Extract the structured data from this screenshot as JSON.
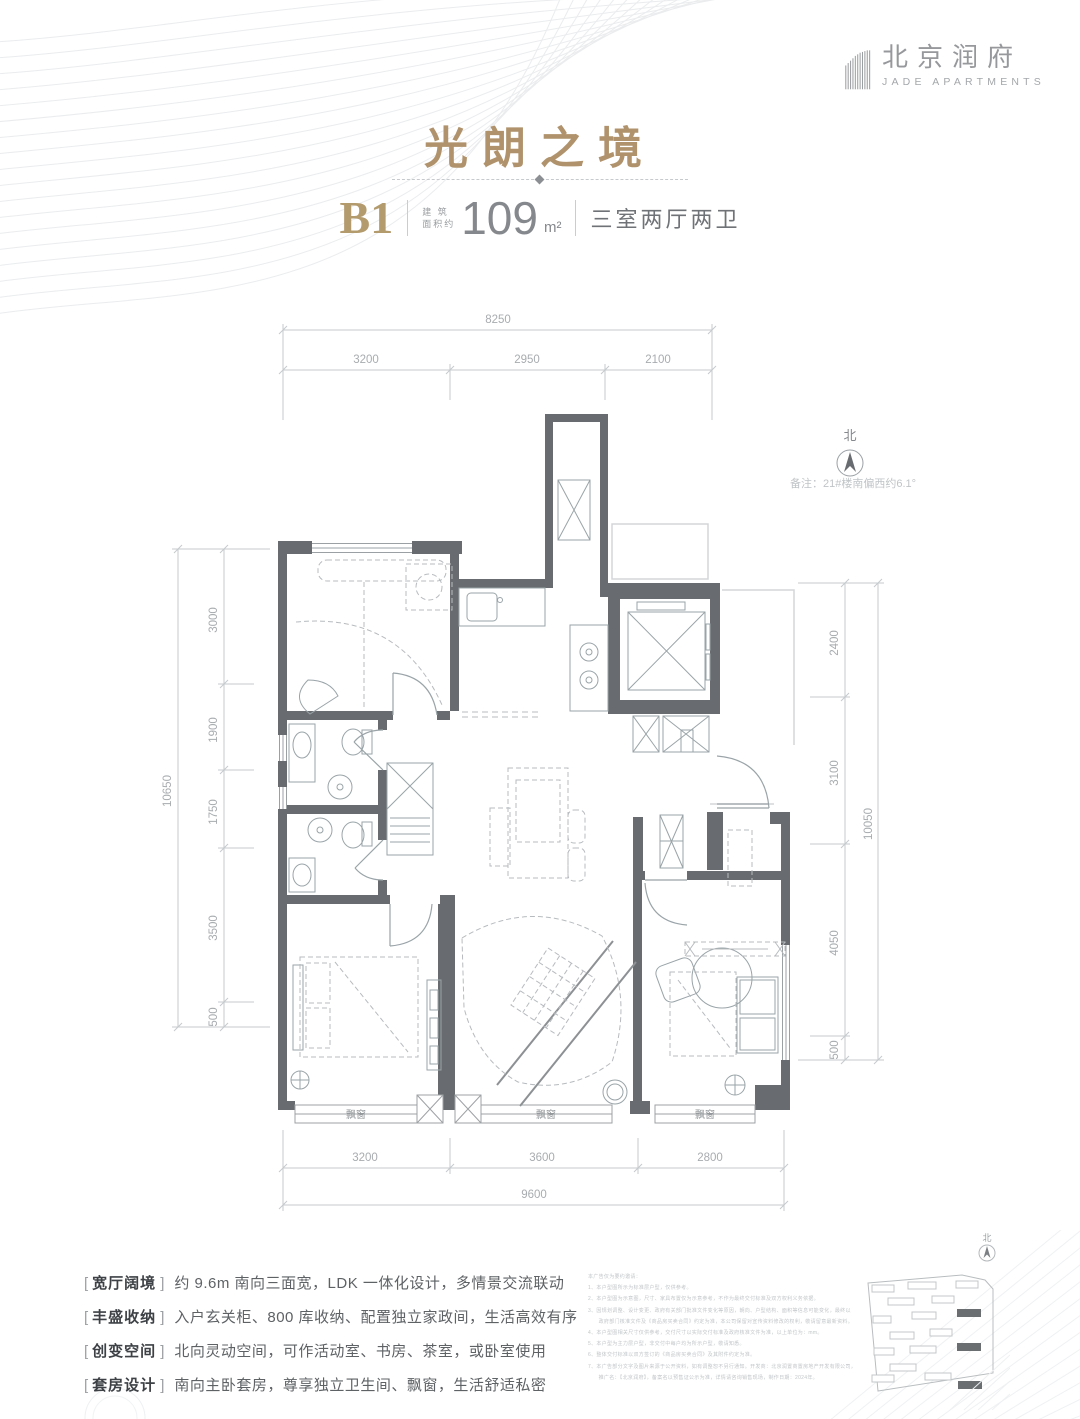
{
  "brand": {
    "name_cn": "北京润府",
    "name_en": "JADE APARTMENTS"
  },
  "title": "光朗之境",
  "unit": {
    "code": "B1",
    "area_label_line1": "建 筑",
    "area_label_line2": "面积约",
    "area_value": "109",
    "area_unit": "m²",
    "layout": "三室两厅两卫"
  },
  "north": {
    "label": "北",
    "note": "备注：21#楼南偏西约6.1°"
  },
  "plan": {
    "dims_top": {
      "total": "8250",
      "segments": [
        "3200",
        "2950",
        "2100"
      ]
    },
    "dims_left": {
      "total": "10650",
      "segments": [
        "3000",
        "1900",
        "1750",
        "3500",
        "500"
      ]
    },
    "dims_right": {
      "total": "10050",
      "segments": [
        "2400",
        "3100",
        "4050",
        "500"
      ]
    },
    "dims_bottom": {
      "total": "9600",
      "segments": [
        "3200",
        "3600",
        "2800"
      ]
    },
    "bay_labels": [
      "飘窗",
      "飘窗",
      "飘窗"
    ]
  },
  "sitemap_north_label": "北",
  "features": [
    {
      "tag": "宽厅阔境",
      "desc": "约 9.6m 南向三面宽，LDK 一体化设计，多情景交流联动"
    },
    {
      "tag": "丰盛收纳",
      "desc": "入户玄关柜、800 库收纳、配置独立家政间，生活高效有序"
    },
    {
      "tag": "创变空间",
      "desc": "北向灵动空间，可作活动室、书房、茶室，或卧室使用"
    },
    {
      "tag": "套房设计",
      "desc": "南向主卧套房，尊享独立卫生间、飘窗，生活舒适私密"
    }
  ],
  "disclaimer": {
    "lines": [
      "本广告仅为要约邀请：",
      "1、本户型图所示为标准层户型，仅供参考。",
      "2、本户型图为示意图，尺寸、家具布置仅为示意参考，不作为最终交付标准及双方权利义务依据。",
      "3、因规划调整、设计变更、政府有关部门批准文件变化等原因，朝向、户型结构、面积等信息可能变化，最终以",
      "　　政府部门核准文件及《商品房买卖合同》约定为准，本公司保留对宣传资料修改的权利，敬请留意最新资料。",
      "4、本户型图相关尺寸仅供参考，交付尺寸以实际交付标准及政府核准文件为准，以上单位为：mm。",
      "5、本户型为主力层户型，非交付中每户均为所示户型，敬请知悉。",
      "6、整体交付标准以双方签订的《商品房买卖合同》及其附件约定为准。",
      "7、本广告部分文字及图片来源于公开资料，如有调整恕不另行通知。开发商：北京润置商置房地产开发有限公司，",
      "　　推广名：【北京润府】，备案名以预售证公示为准，详情请咨询销售现场，制作日期：2024年。"
    ]
  }
}
